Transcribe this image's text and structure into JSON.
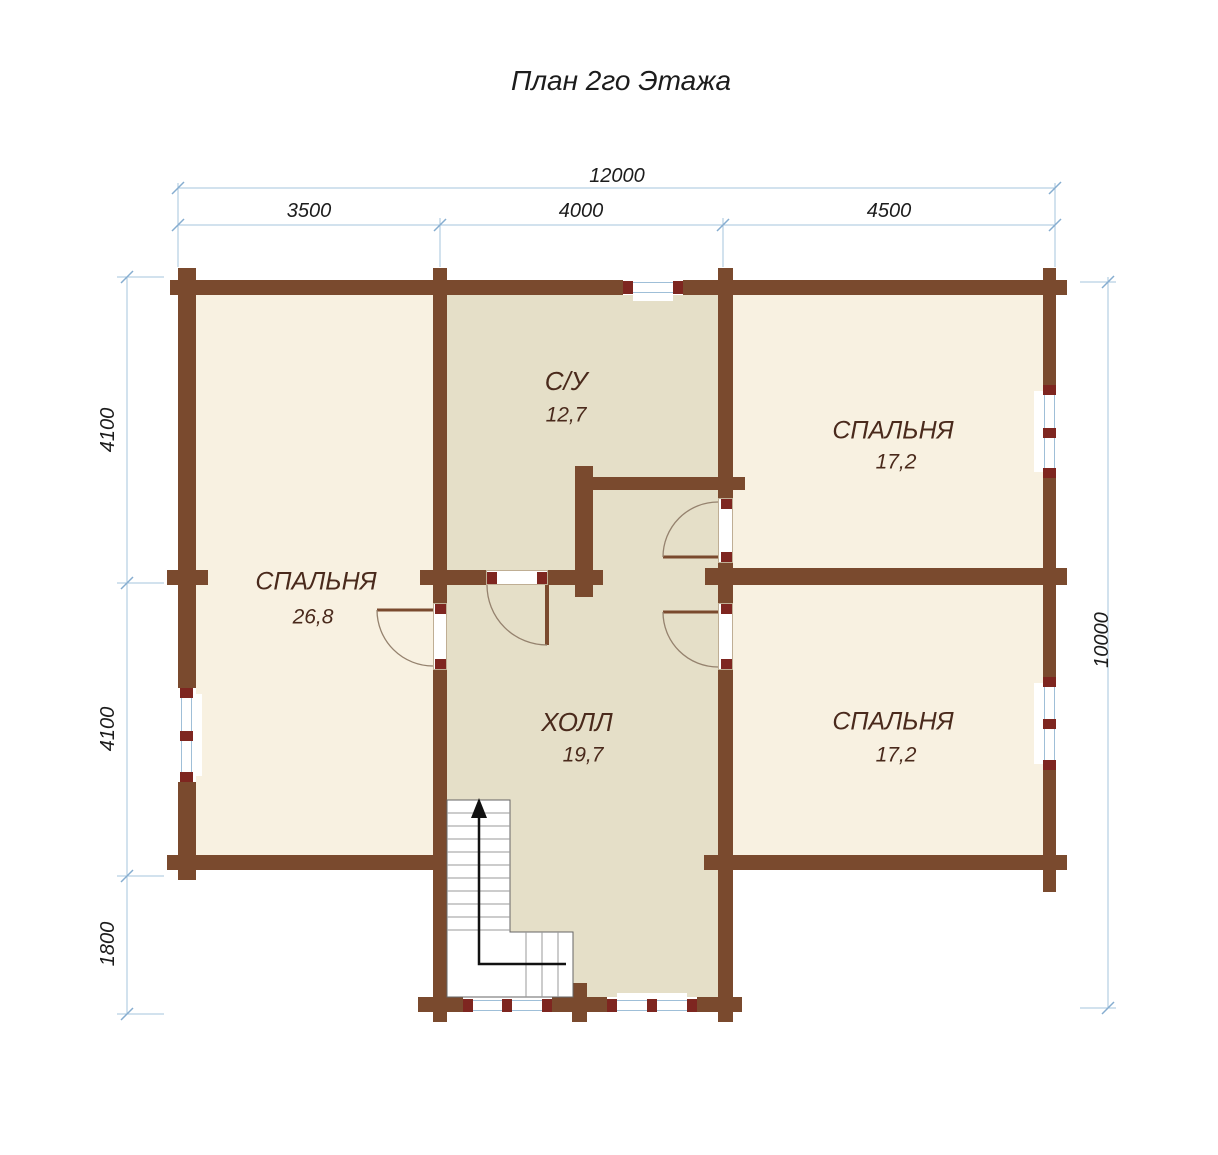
{
  "title": "План 2го Этажа",
  "dimensions": {
    "top_total": "12000",
    "top_segments": [
      "3500",
      "4000",
      "4500"
    ],
    "left_segments": [
      "4100",
      "4100",
      "1800"
    ],
    "right_total": "10000"
  },
  "rooms": {
    "bathroom": {
      "name": "С/У",
      "area": "12,7"
    },
    "bedroom_left": {
      "name": "СПАЛЬНЯ",
      "area": "26,8"
    },
    "bedroom_top_right": {
      "name": "СПАЛЬНЯ",
      "area": "17,2"
    },
    "bedroom_bottom_right": {
      "name": "СПАЛЬНЯ",
      "area": "17,2"
    },
    "hall": {
      "name": "ХОЛЛ",
      "area": "19,7"
    }
  },
  "colors": {
    "wall": "#7A4A2E",
    "bedroom_floor": "#F8F1E1",
    "hall_floor": "#E5DFC8",
    "window_jamb": "#7E2620",
    "glazing": "#9FBFD8",
    "dimension_line": "#A6C4DE",
    "room_label": "#4A2A1C",
    "stair_arrow": "#111111"
  }
}
